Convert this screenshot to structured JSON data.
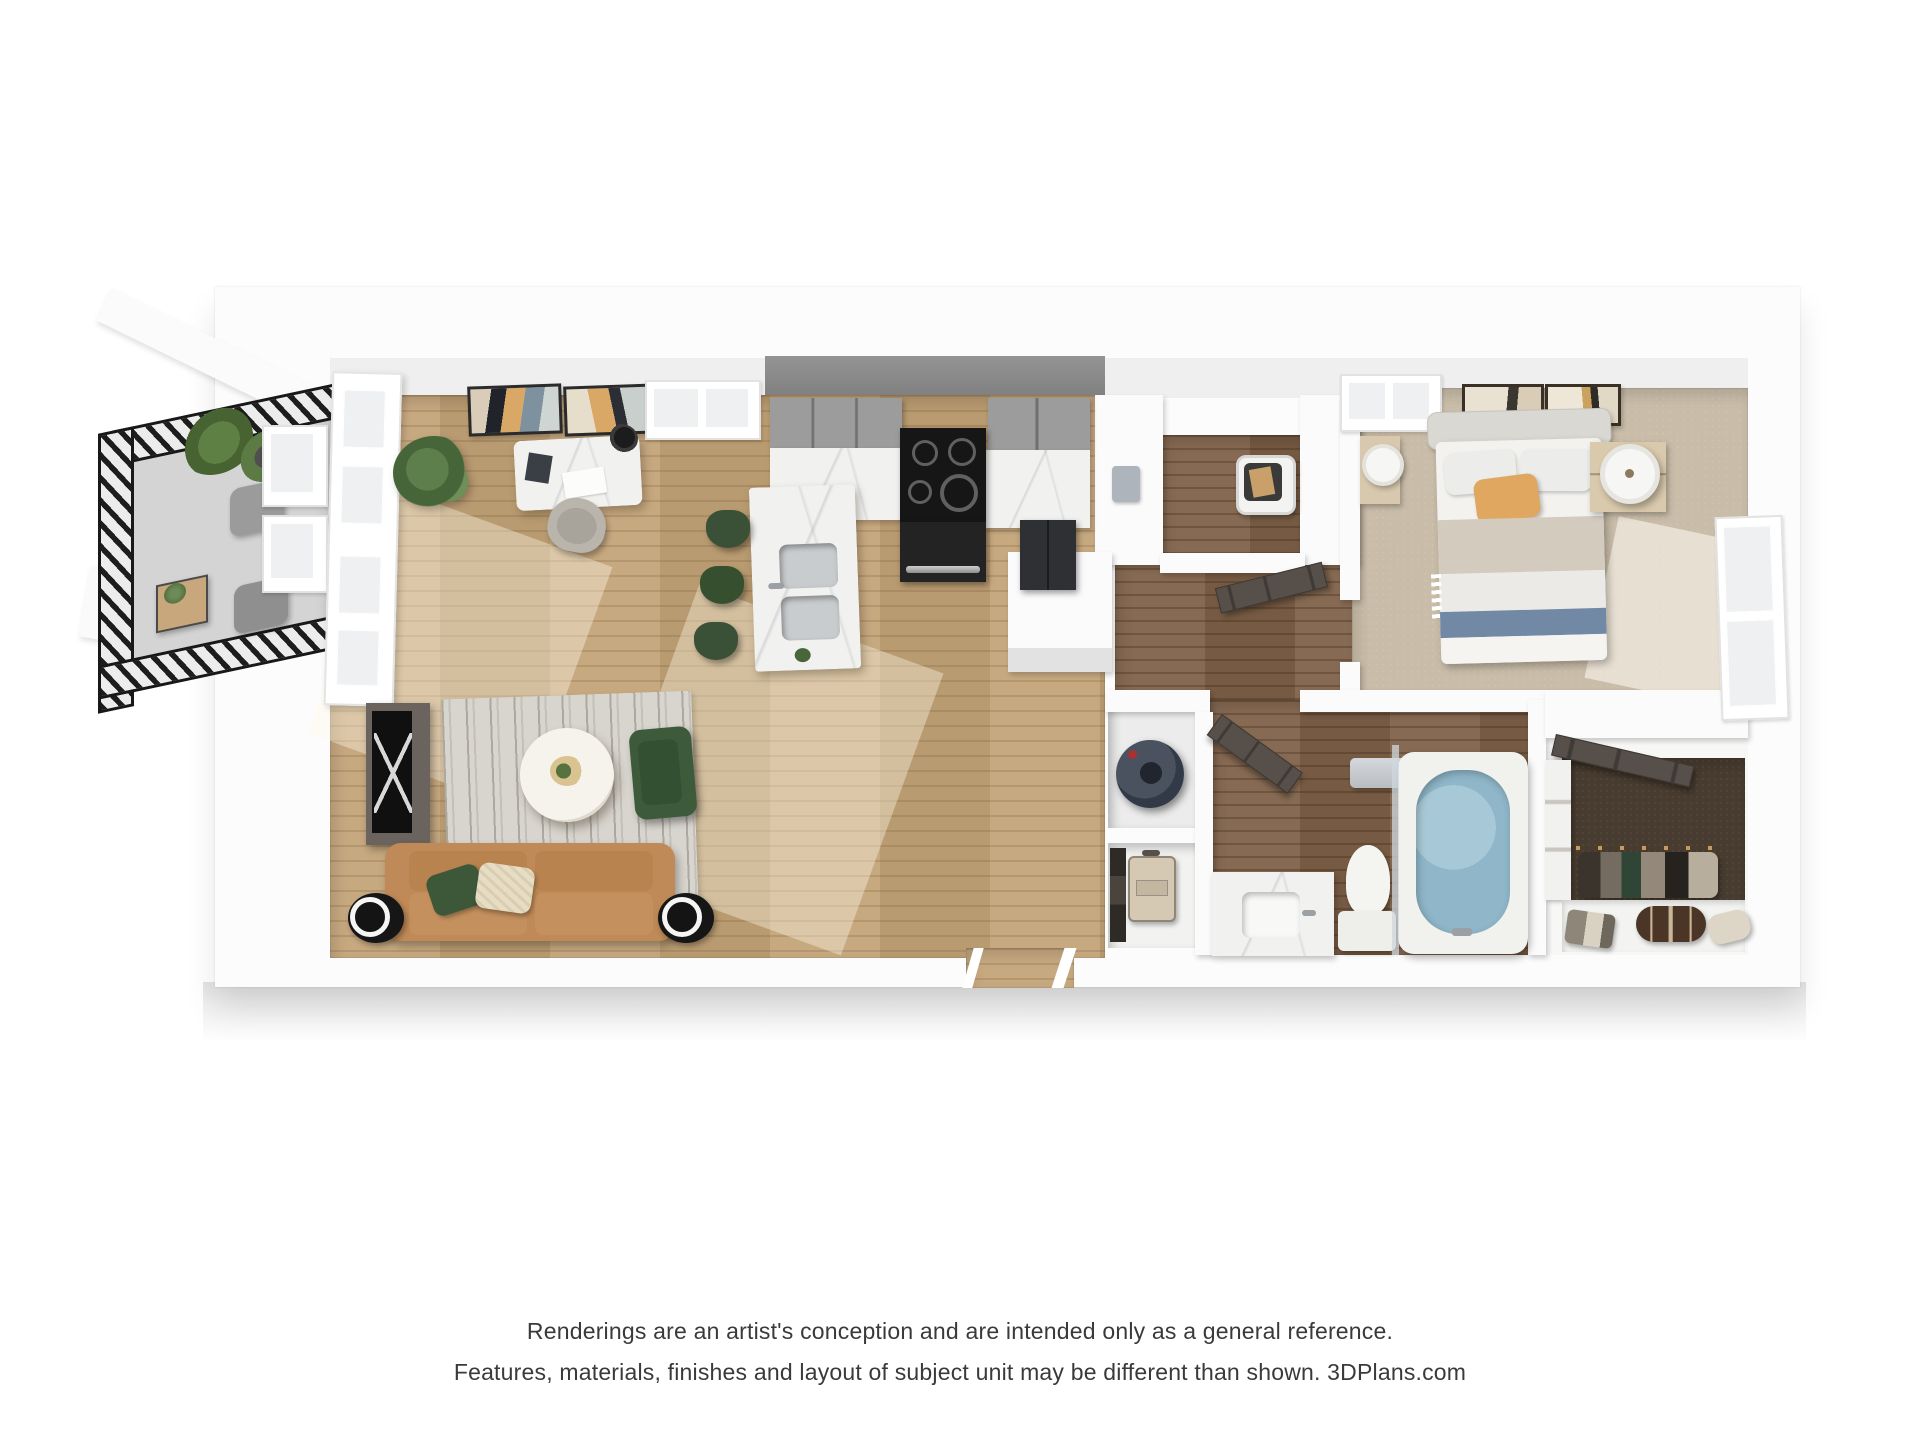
{
  "disclaimer": {
    "line1": "Renderings are an artist's conception and are intended only as a general reference.",
    "line2": "Features, materials, finishes and layout of subject unit may be different than shown. 3DPlans.com"
  },
  "brand": "3DPlans.com",
  "floorplan": {
    "view": "3d-top-down-dollhouse-render",
    "unit_type": "one-bedroom-one-bath-apartment",
    "rooms": [
      {
        "name": "balcony",
        "floor": "concrete-gray",
        "furniture": [
          "black-metal-railing",
          "two-gray-patio-chairs",
          "small-wood-side-table",
          "potted-aloe-plant",
          "potted-plant"
        ]
      },
      {
        "name": "living-dining-area",
        "floor": "light-oak-wood",
        "furniture": [
          "desk-with-marble-top",
          "desk-lamp",
          "desk-chair",
          "two-abstract-wall-art-frames",
          "indoor-plant",
          "french-door-to-balcony",
          "media-console-with-tv",
          "striped-gray-rug",
          "round-white-coffee-table",
          "green-velvet-armchair",
          "camel-sofa",
          "green-pillow",
          "cream-pillow",
          "two-black-side-tables-with-lamps"
        ]
      },
      {
        "name": "kitchen",
        "floor": "light-oak-wood",
        "furniture": [
          "gray-upper-cabinets",
          "dark-accent-wall",
          "electric-range-with-oven",
          "marble-countertop",
          "dark-refrigerator",
          "marble-island-with-double-sink",
          "three-green-bar-stools"
        ]
      },
      {
        "name": "laundry-utility-room",
        "floor": "dark-wood",
        "furniture": [
          "white-laundry-basket"
        ]
      },
      {
        "name": "hallway",
        "floor": "dark-wood",
        "furniture": [
          "open-dark-doors"
        ]
      },
      {
        "name": "water-heater-closet",
        "floor": "white",
        "furniture": [
          "water-heater-cylinder"
        ]
      },
      {
        "name": "storage-closet",
        "floor": "white",
        "furniture": [
          "suitcase",
          "hanging-coats"
        ]
      },
      {
        "name": "bathroom",
        "floor": "dark-wood",
        "furniture": [
          "marble-vanity-with-sink",
          "toilet",
          "bathtub-with-blue-water",
          "glass-shower-panel",
          "towel-bar"
        ]
      },
      {
        "name": "bedroom",
        "floor": "beige-carpet",
        "furniture": [
          "upholstered-bed",
          "white-and-gray-bedding",
          "tan-accent-pillow",
          "blue-throw-blanket",
          "two-nightstands",
          "two-drum-lamps",
          "two-abstract-art-frames",
          "top-wall-window",
          "right-wall-window"
        ]
      },
      {
        "name": "walk-in-closet",
        "floor": "dark-brown-carpet",
        "furniture": [
          "hanging-clothes",
          "shoe-shelf",
          "patterned-duffel-bag",
          "cream-bag",
          "side-shelving"
        ]
      }
    ],
    "palette": {
      "background": "#ffffff",
      "walls": "#fbfbfb",
      "accent_wall": "#8a8a8a",
      "wood_light": "#c3a377",
      "wood_dark": "#7f6148",
      "carpet_beige": "#c9bca8",
      "carpet_closet": "#483b2f",
      "marble": "#f1f1ef",
      "sofa_camel": "#bf8a57",
      "green_velvet": "#3d5a3b",
      "tub_water_blue": "#8fb7c9",
      "throw_blue": "#7189a5",
      "pillow_tan": "#dfa75f",
      "railing_black": "#1d1d1d",
      "water_heater": "#414a57",
      "text": "#3a3a3a"
    }
  }
}
